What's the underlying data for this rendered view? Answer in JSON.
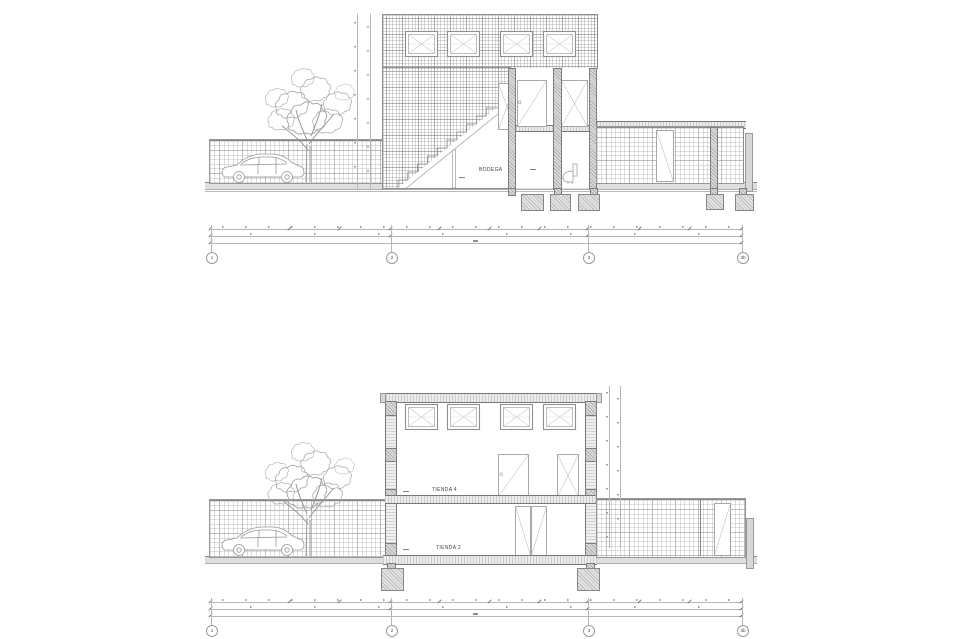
{
  "sheet": {
    "background": "#ffffff",
    "type_note": "two architectural building sections, one above the other"
  },
  "colors": {
    "paper": "#ffffff",
    "line": "#9a9a9a",
    "dark_line": "#707070",
    "mesh": "#b0b0b0",
    "concrete_fill": "#e2e2e2",
    "ground_fill": "#dedede",
    "text": "#3f3f3f"
  },
  "section_a": {
    "room_label": "BODEGA",
    "grid_bubbles": [
      {
        "label": "1"
      },
      {
        "label": "2"
      },
      {
        "label": "3"
      },
      {
        "label": "3b"
      }
    ]
  },
  "section_b": {
    "room_labels": {
      "upper": "TIENDA 4",
      "lower": "TIENDA 2"
    },
    "grid_bubbles": [
      {
        "label": "1"
      },
      {
        "label": "2"
      },
      {
        "label": "3"
      },
      {
        "label": "3b"
      }
    ]
  }
}
